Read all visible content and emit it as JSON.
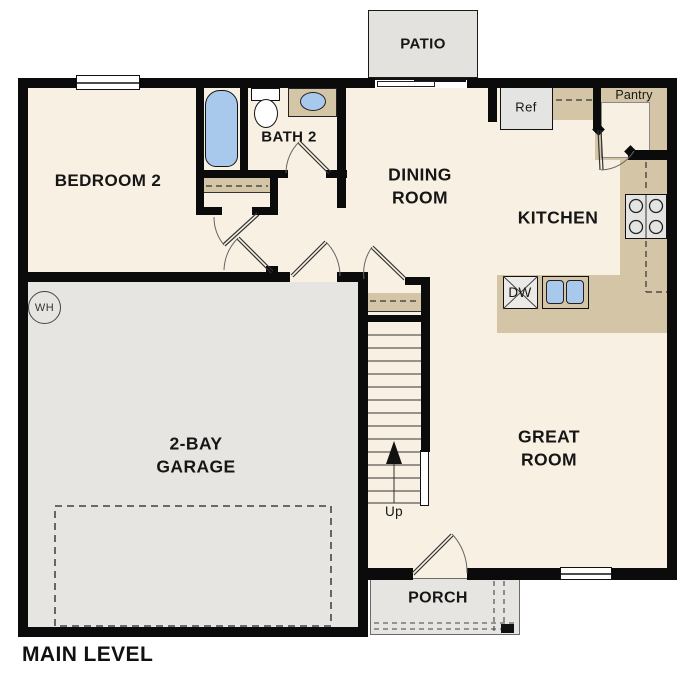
{
  "title": "MAIN LEVEL",
  "colors": {
    "floor": "#f8f1e3",
    "hard_floor": "#e6e5e1",
    "counter": "#d4c5a6",
    "water": "#a9c9ec",
    "wall": "#0b0b0b",
    "appliance": "#e4e4e2"
  },
  "rooms": {
    "bedroom2": "BEDROOM 2",
    "bath2": "BATH 2",
    "dining_line1": "DINING",
    "dining_line2": "ROOM",
    "kitchen": "KITCHEN",
    "great_line1": "GREAT",
    "great_line2": "ROOM",
    "garage_line1": "2-BAY",
    "garage_line2": "GARAGE",
    "patio": "PATIO",
    "porch": "PORCH",
    "pantry": "Pantry"
  },
  "fixtures": {
    "refrigerator": "Ref",
    "dishwasher": "DW",
    "stairs_direction": "Up",
    "water_heater": "WH"
  }
}
